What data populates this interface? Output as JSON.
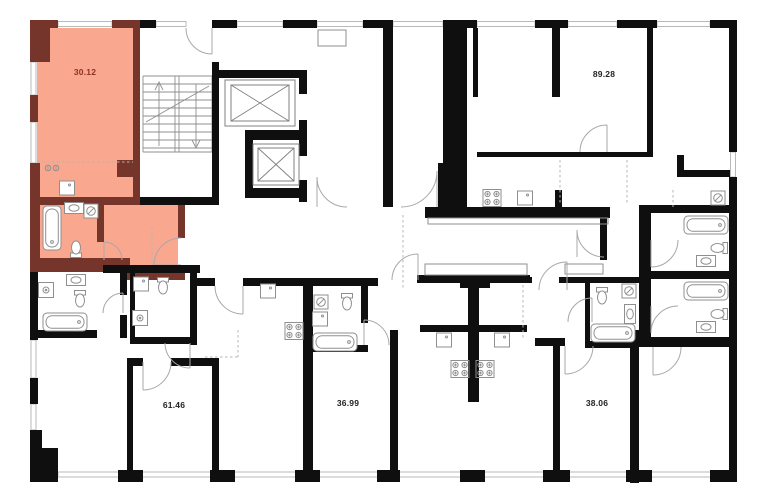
{
  "floor_plan": {
    "type": "residential-floor-plan",
    "units": [
      {
        "label": "30.12",
        "highlighted": true
      },
      {
        "label": "89.28",
        "highlighted": false
      },
      {
        "label": "61.46",
        "highlighted": false
      },
      {
        "label": "36.99",
        "highlighted": false
      },
      {
        "label": "38.06",
        "highlighted": false
      }
    ],
    "colors": {
      "wall": "#0f0f0f",
      "highlight_fill": "#f9a78f",
      "highlight_wall": "#76352b",
      "highlight_label": "#8d3221",
      "label": "#222222",
      "fixture_line": "#8f8f8f",
      "window_line": "#b9b9b9",
      "door_line": "#a8a8a8",
      "dash_line": "#b4b4b4"
    },
    "icons": {
      "stairs": "stairs-icon",
      "elevator": "elevator-icon",
      "bathtub": "bathtub-icon",
      "toilet": "toilet-icon",
      "washing_machine": "washing-machine-icon",
      "shower": "shower-icon",
      "kitchen_sink": "kitchen-sink-icon",
      "vanity_sink": "vanity-sink-icon",
      "stove": "stove-icon"
    }
  }
}
